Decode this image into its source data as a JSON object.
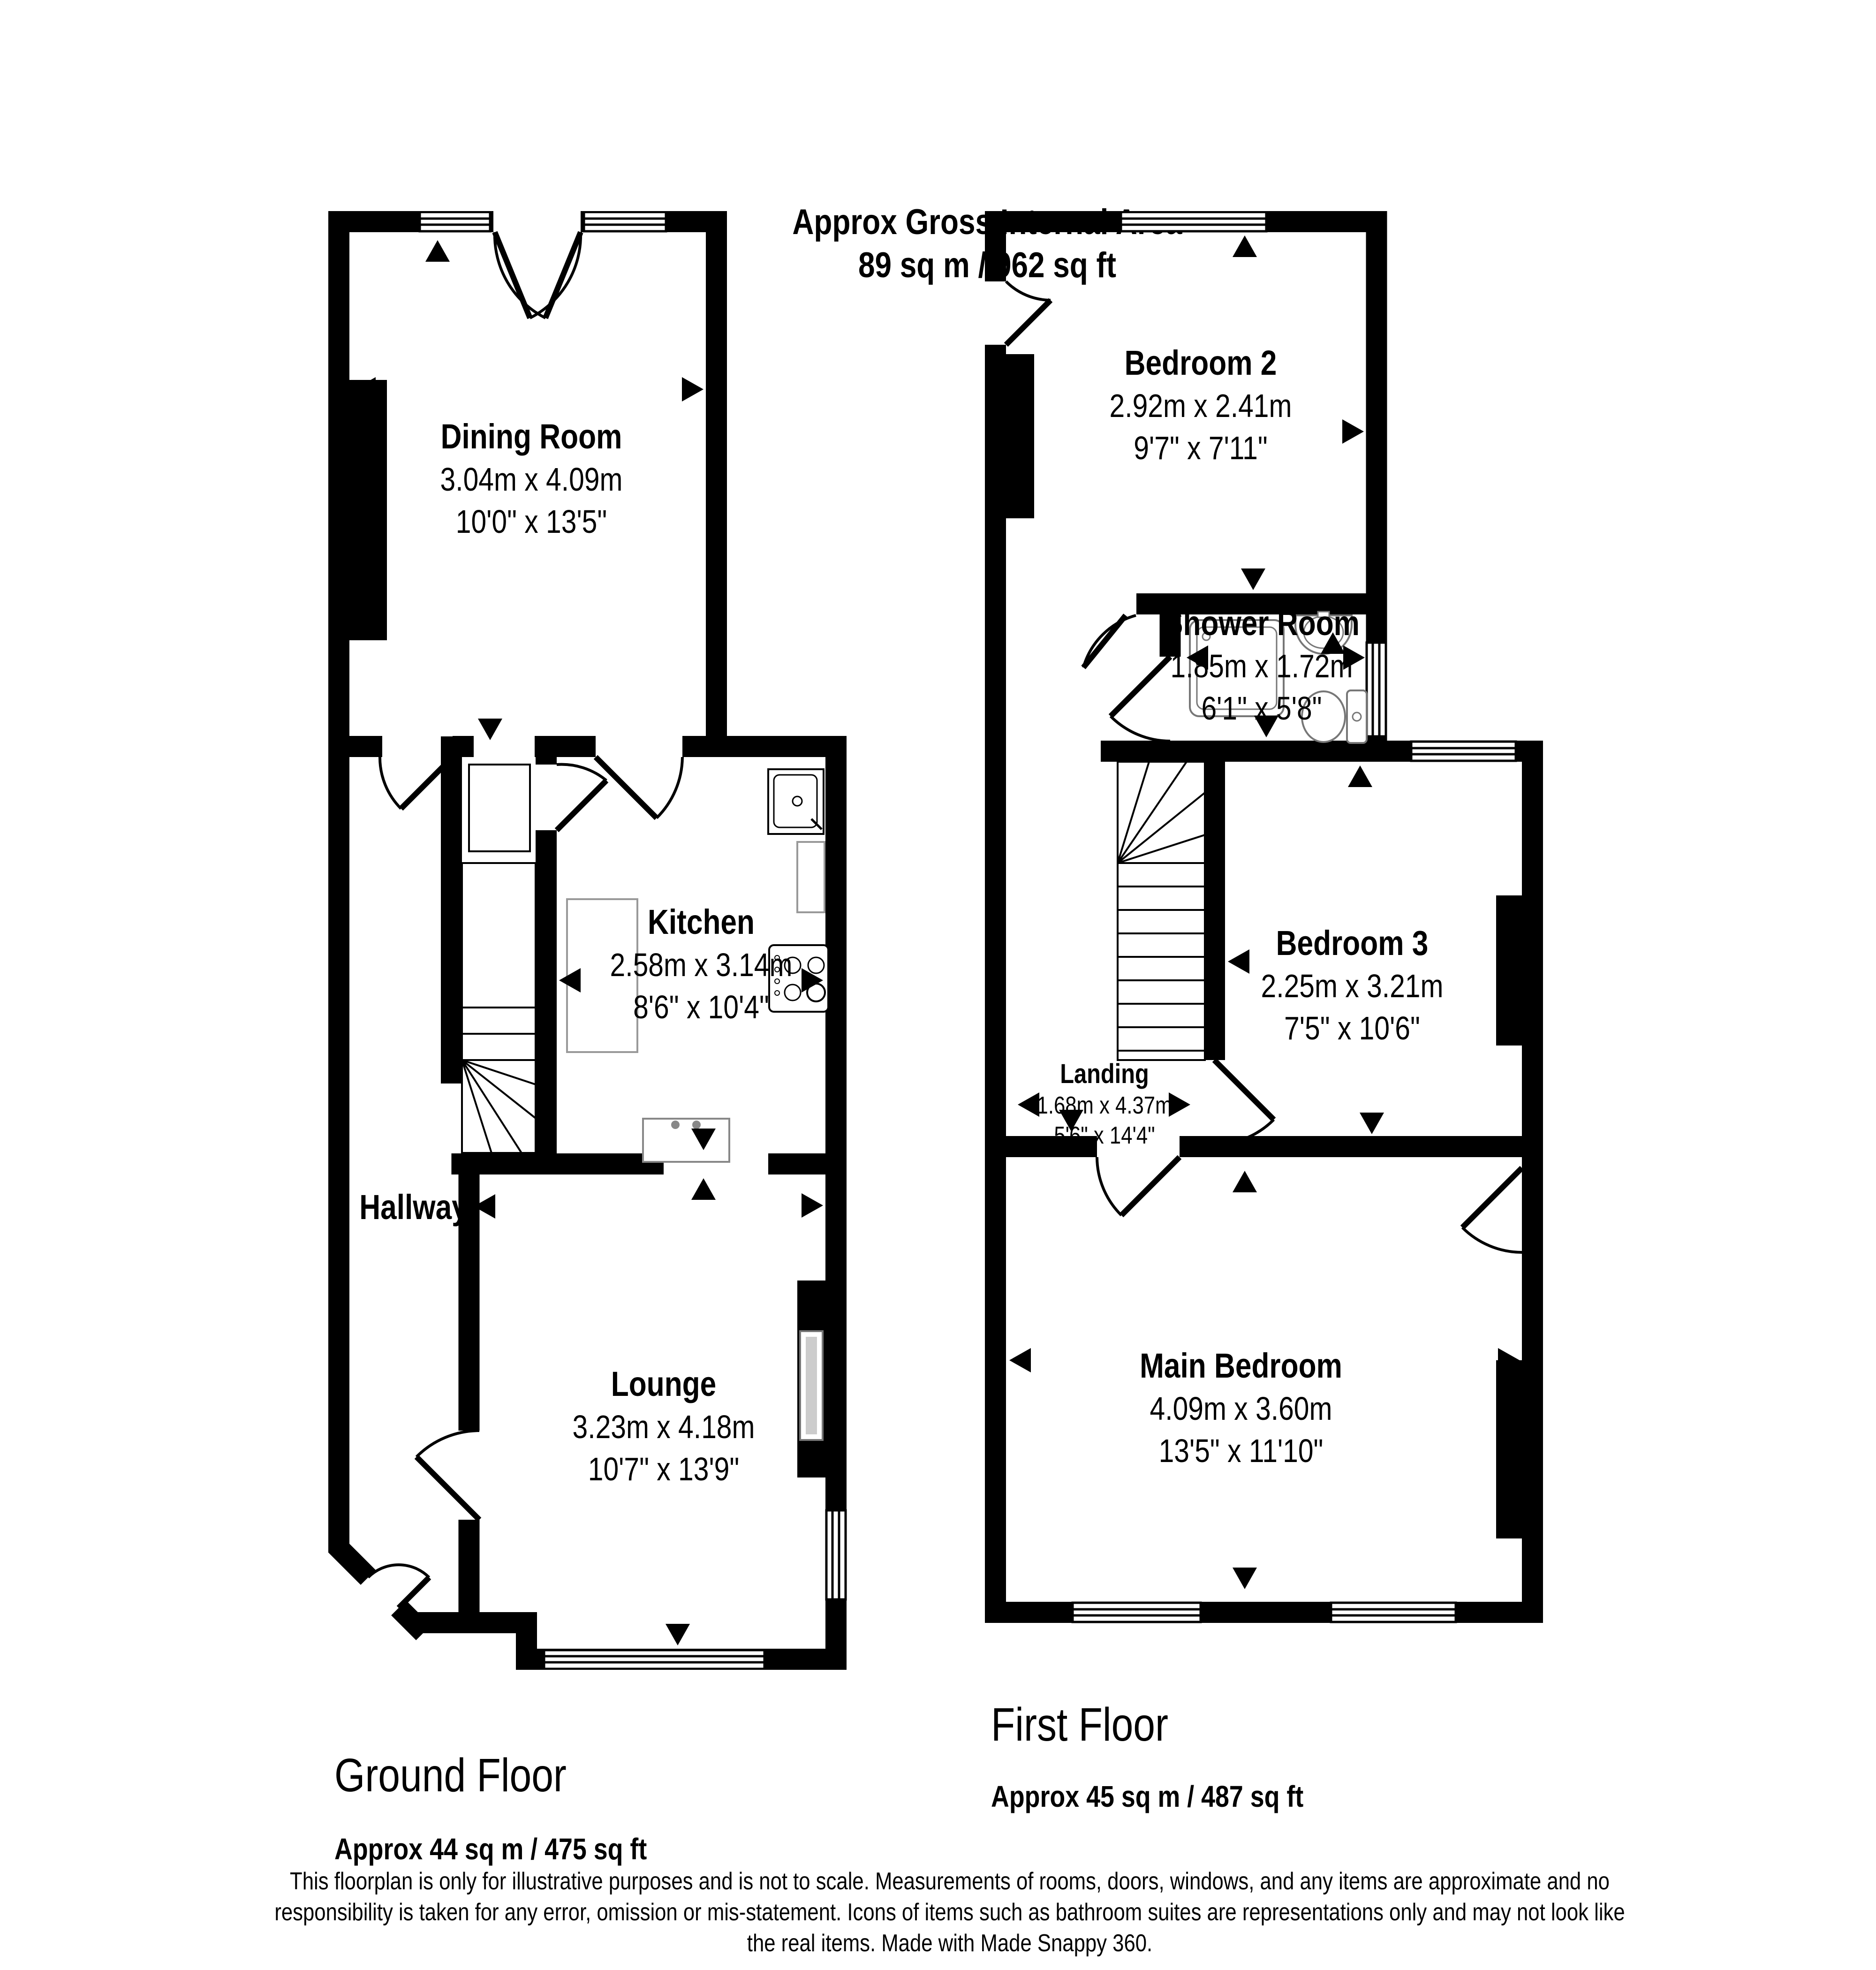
{
  "header": {
    "line1": "Approx Gross Internal Area",
    "line2": "89 sq m / 962 sq ft"
  },
  "ground_floor": {
    "title": "Ground Floor",
    "area": "Approx 44 sq m / 475 sq ft",
    "rooms": {
      "dining": {
        "name": "Dining Room",
        "metric": "3.04m x 4.09m",
        "imperial": "10'0\" x 13'5\""
      },
      "kitchen": {
        "name": "Kitchen",
        "metric": "2.58m x 3.14m",
        "imperial": "8'6\" x 10'4\""
      },
      "hallway": {
        "name": "Hallway"
      },
      "lounge": {
        "name": "Lounge",
        "metric": "3.23m x 4.18m",
        "imperial": "10'7\" x 13'9\""
      }
    }
  },
  "first_floor": {
    "title": "First Floor",
    "area": "Approx 45 sq m / 487 sq ft",
    "rooms": {
      "bedroom2": {
        "name": "Bedroom 2",
        "metric": "2.92m x 2.41m",
        "imperial": "9'7\" x 7'11\""
      },
      "shower": {
        "name": "Shower Room",
        "metric": "1.85m x 1.72m",
        "imperial": "6'1\" x 5'8\""
      },
      "bedroom3": {
        "name": "Bedroom 3",
        "metric": "2.25m x 3.21m",
        "imperial": "7'5\" x 10'6\""
      },
      "landing": {
        "name": "Landing",
        "metric": "1.68m x 4.37m",
        "imperial": "5'6\" x 14'4\""
      },
      "main_bedroom": {
        "name": "Main Bedroom",
        "metric": "4.09m x 3.60m",
        "imperial": "13'5\" x 11'10\""
      }
    }
  },
  "footer": {
    "disclaimer": "This floorplan is only for illustrative purposes and is not to scale. Measurements of rooms, doors, windows, and any items are approximate and no responsibility is taken for any error, omission or mis-statement. Icons of items such as bathroom suites are representations only and may not look like the real items. Made with Made Snappy 360."
  }
}
